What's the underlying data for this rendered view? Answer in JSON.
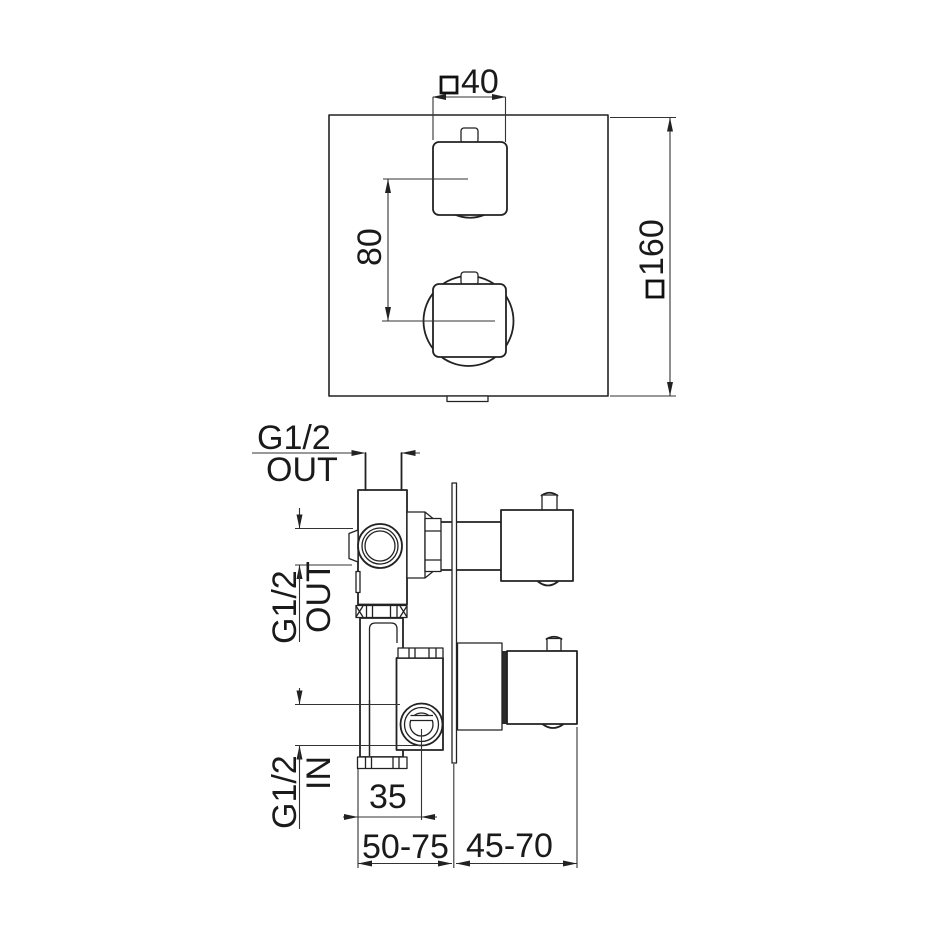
{
  "page": {
    "background": "#ffffff",
    "line_color": "#222222"
  },
  "drawing": {
    "front_view": {
      "dim_handle_width": {
        "symbol": "□",
        "value": "40"
      },
      "dim_handle_spacing": "80",
      "dim_plate_size": {
        "symbol": "□",
        "value": "160"
      }
    },
    "side_view": {
      "label_top_outlet": {
        "thread": "G1/2",
        "port": "OUT"
      },
      "label_front_outlet": {
        "thread": "G1/2",
        "port": "OUT"
      },
      "label_inlet": {
        "thread": "G1/2",
        "port": "IN"
      },
      "dim_inlet_offset": "35",
      "dim_recess_depth": "50-75",
      "dim_handle_projection": "45-70"
    }
  }
}
